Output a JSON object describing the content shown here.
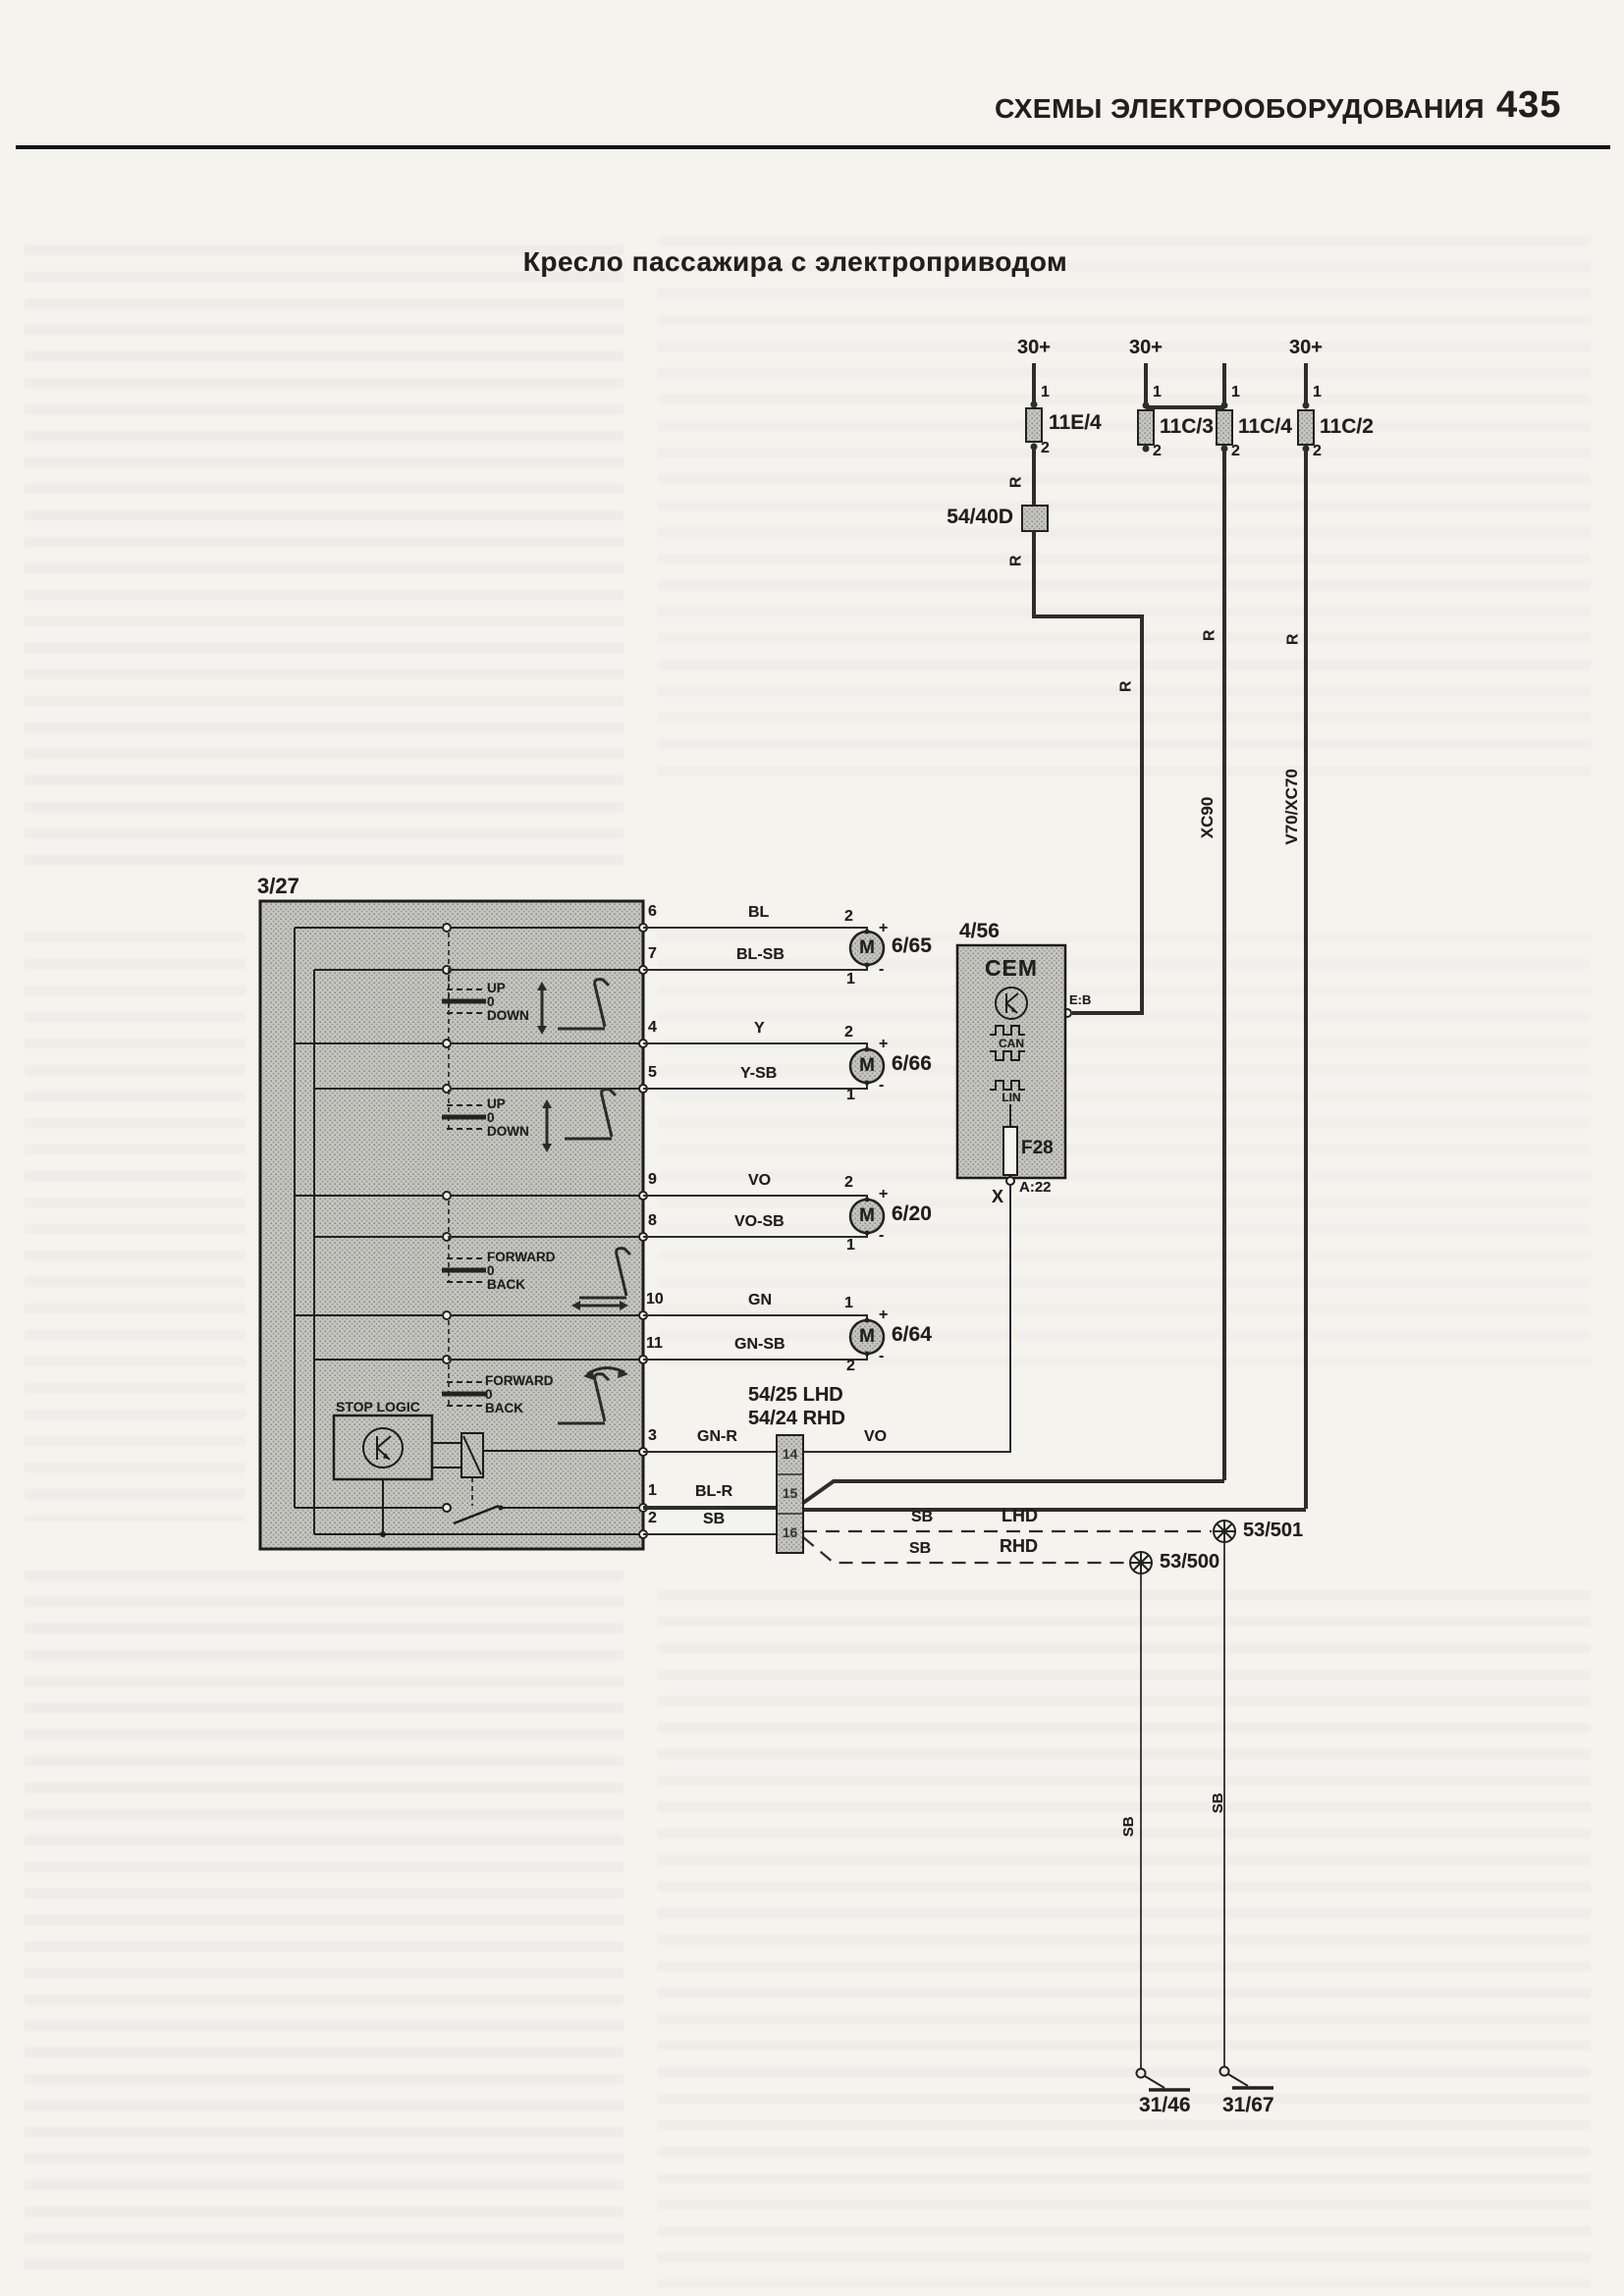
{
  "page": {
    "header": "СХЕМЫ ЭЛЕКТРООБОРУДОВАНИЯ",
    "page_number": "435",
    "title": "Кресло пассажира с электроприводом"
  },
  "power": [
    "30+",
    "30+",
    "30+"
  ],
  "wires": {
    "r": "R",
    "sb": "SB"
  },
  "fuses": [
    {
      "id": "11E/4",
      "top": "1",
      "bottom": "2"
    },
    {
      "id": "11C/3",
      "top": "1",
      "bottom": "2"
    },
    {
      "id": "11C/4",
      "top": "1",
      "bottom": "2"
    },
    {
      "id": "11C/2",
      "top": "1",
      "bottom": "2"
    }
  ],
  "inline_connector": {
    "id": "54/40D"
  },
  "models": {
    "xc90": "XC90",
    "v70": "V70/XC70"
  },
  "switch_module": {
    "id": "3/27",
    "stop_logic": "STOP LOGIC",
    "pins": {
      "p6": "6",
      "p7": "7",
      "p4": "4",
      "p5": "5",
      "p9": "9",
      "p8": "8",
      "p10": "10",
      "p11": "11",
      "p3": "3",
      "p1": "1",
      "p2": "2"
    },
    "groups": [
      {
        "up": "UP",
        "zero": "0",
        "down": "DOWN"
      },
      {
        "up": "UP",
        "zero": "0",
        "down": "DOWN"
      },
      {
        "up": "FORWARD",
        "zero": "0",
        "down": "BACK"
      },
      {
        "up": "FORWARD",
        "zero": "0",
        "down": "BACK"
      }
    ]
  },
  "motors": [
    {
      "id": "6/65",
      "sym": "M",
      "wire_top": "BL",
      "wire_bottom": "BL-SB",
      "pin_top": "2",
      "pin_bottom": "1",
      "plus": "+",
      "minus": "-"
    },
    {
      "id": "6/66",
      "sym": "M",
      "wire_top": "Y",
      "wire_bottom": "Y-SB",
      "pin_top": "2",
      "pin_bottom": "1",
      "plus": "+",
      "minus": "-"
    },
    {
      "id": "6/20",
      "sym": "M",
      "wire_top": "VO",
      "wire_bottom": "VO-SB",
      "pin_top": "2",
      "pin_bottom": "1",
      "plus": "+",
      "minus": "-"
    },
    {
      "id": "6/64",
      "sym": "M",
      "wire_top": "GN",
      "wire_bottom": "GN-SB",
      "pin_top": "1",
      "pin_bottom": "2",
      "plus": "+",
      "minus": "-"
    }
  ],
  "cem": {
    "id": "4/56",
    "name": "CEM",
    "can": "CAN",
    "lin": "LIN",
    "fuse": "F28",
    "pin_a22": "A:22",
    "x_mark": "X",
    "pin_eb": "E:B"
  },
  "harness": {
    "lhd": "54/25 LHD",
    "rhd": "54/24 RHD",
    "cells": [
      "14",
      "15",
      "16"
    ],
    "wire_gnr": "GN-R",
    "wire_blr": "BL-R",
    "wire_vo": "VO",
    "route_lhd": "LHD",
    "route_rhd": "RHD"
  },
  "lamps": [
    {
      "id": "53/501"
    },
    {
      "id": "53/500"
    }
  ],
  "grounds": [
    {
      "id": "31/46"
    },
    {
      "id": "31/67"
    }
  ]
}
